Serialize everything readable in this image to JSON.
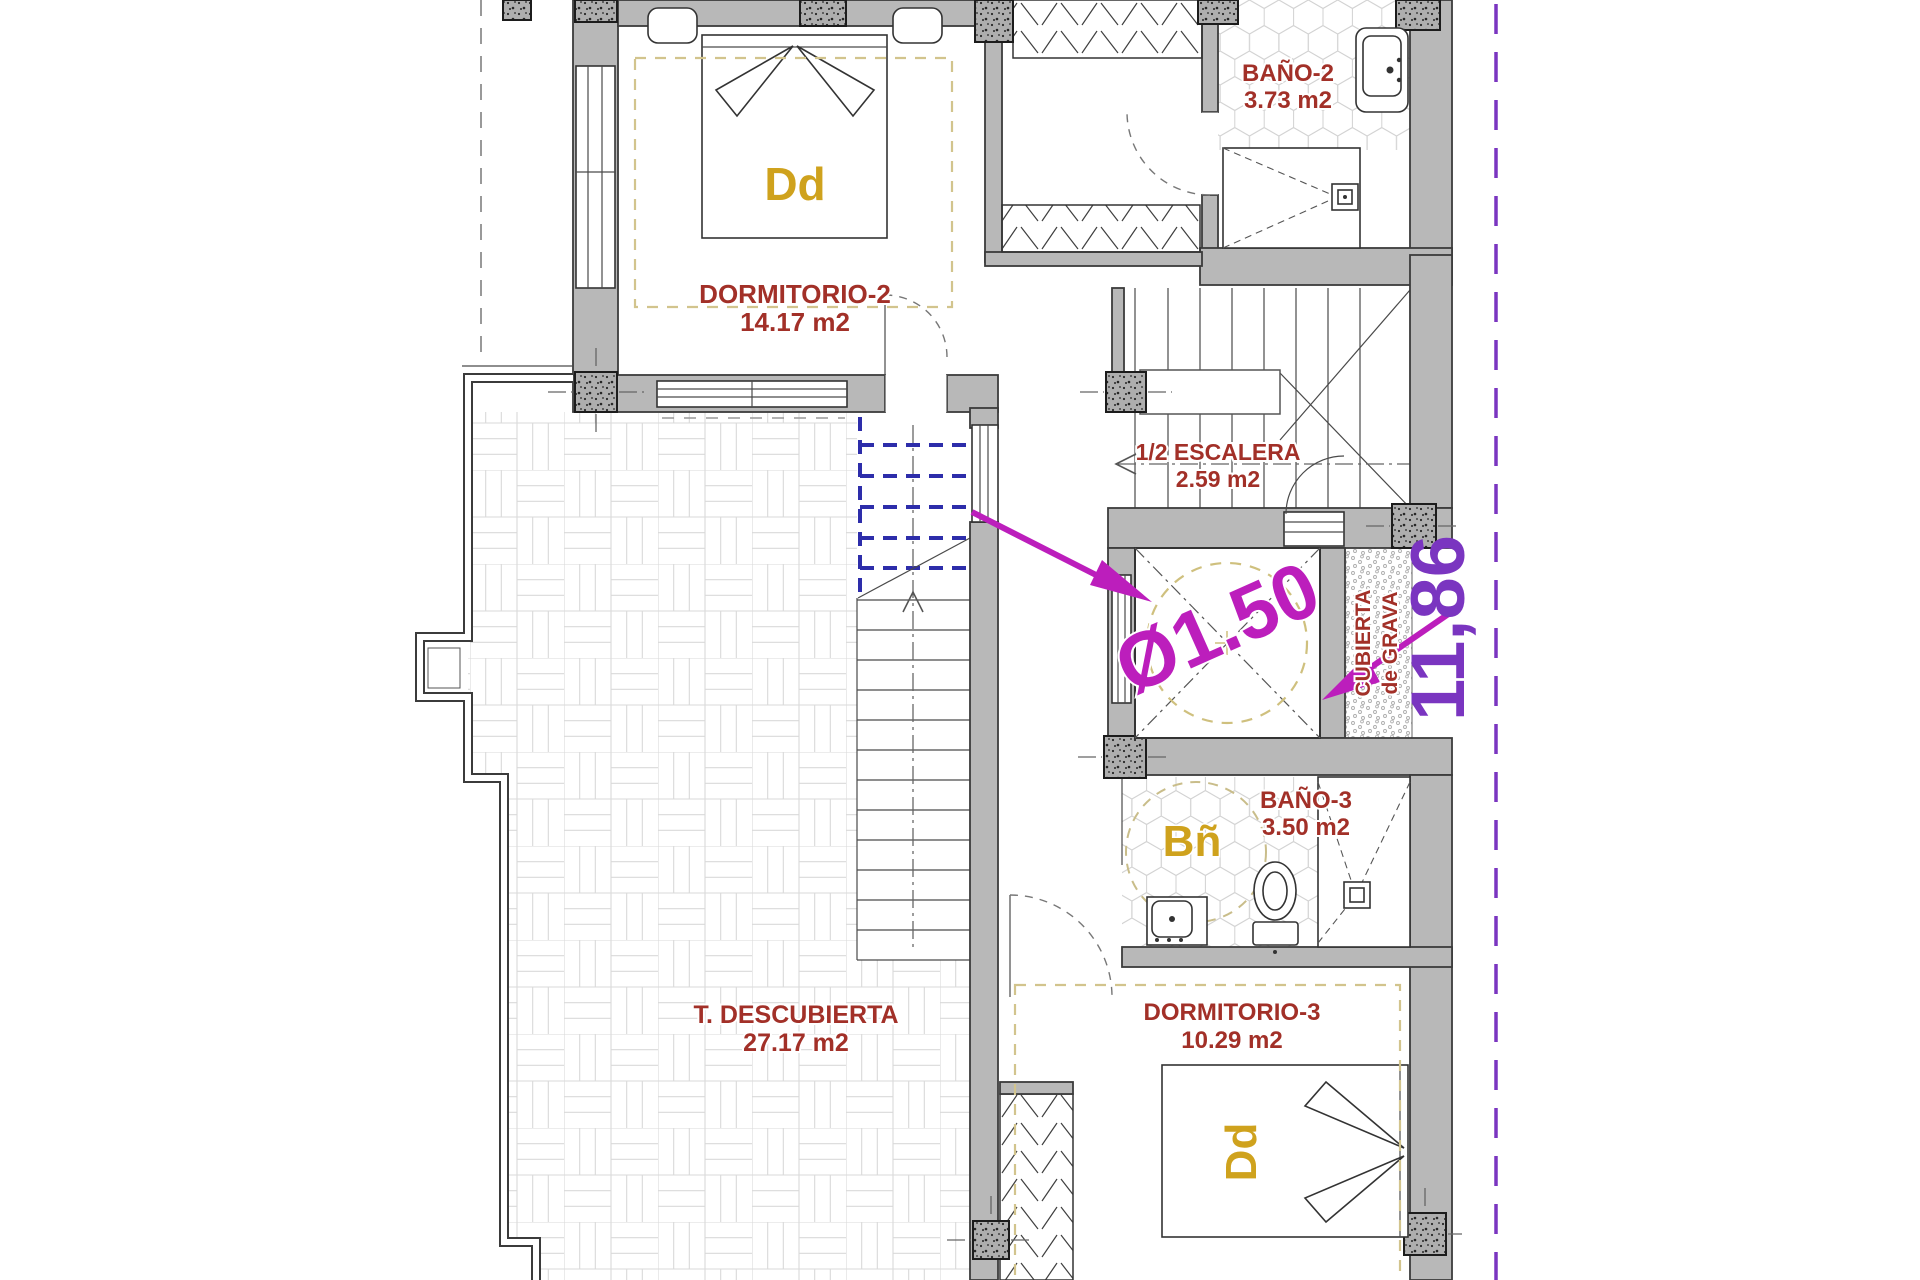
{
  "plan": {
    "rooms": {
      "dormitorio2": {
        "name": "DORMITORIO-2",
        "area": "14.17 m2",
        "bed_label": "Dd"
      },
      "bano2": {
        "name": "BAÑO-2",
        "area": "3.73 m2"
      },
      "media_escalera": {
        "name": "1/2 ESCALERA",
        "area": "2.59 m2"
      },
      "bano3": {
        "name": "BAÑO-3",
        "area": "3.50 m2",
        "bath_label": "Bñ"
      },
      "terraza_descubierta": {
        "name": "T. DESCUBIERTA",
        "area": "27.17 m2"
      },
      "dormitorio3": {
        "name": "DORMITORIO-3",
        "area": "10.29 m2",
        "bed_label": "Dd"
      },
      "cubierta_grava": {
        "line1": "CUBIERTA",
        "line2": "de GRAVA"
      }
    },
    "annotations": {
      "shaft_diameter": "Ø1.50",
      "right_dimension": "11,86"
    },
    "colors": {
      "room_label": "#a23028",
      "furniture_label": "#cfa21d",
      "annotation_magenta": "#bc1ebc",
      "dimension_purple": "#7a35c0",
      "stair_above_blue": "#2d2daa",
      "wall_gray": "#b8b8b8",
      "area_outline_dashed": "#d2c48d"
    }
  }
}
